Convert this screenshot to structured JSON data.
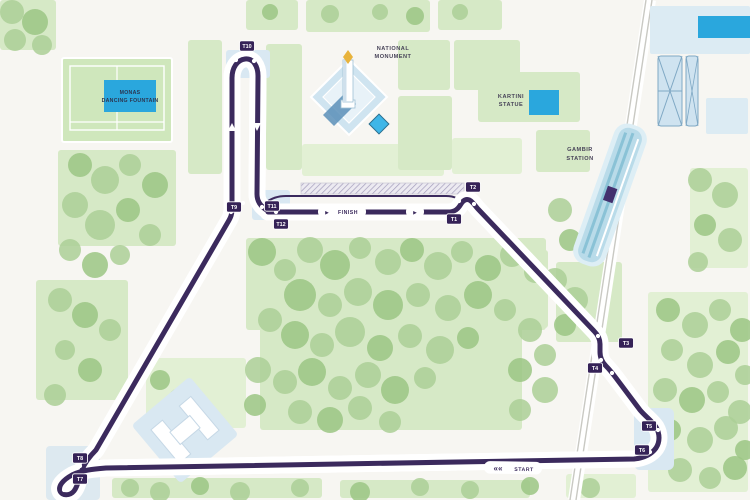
{
  "map": {
    "title": "Jakarta Monas street circuit map",
    "colors": {
      "background": "#f7f6f2",
      "park": "#d6e9c6",
      "park_light": "#e2f0d4",
      "tree": "#accf97",
      "tree_dark": "#9bc584",
      "track": "#3b2a5d",
      "turn_box": "#352257",
      "water_blue": "#2aa7dd",
      "pale_blue": "#d9e8f2",
      "station_blue": "#b9dbe9",
      "station_stripe": "#8ac2d6",
      "rail_gray": "#c9c9c3",
      "label_text": "#474358"
    },
    "labels": {
      "national_monument": [
        "NATIONAL",
        "MONUMENT"
      ],
      "monas_dancing_fountain": [
        "MONAS",
        "DANCING FOUNTAIN"
      ],
      "kartini_statue": [
        "KARTINI",
        "STATUE"
      ],
      "gambir_station": [
        "GAMBIR",
        "STATION"
      ]
    },
    "track": {
      "finish_label": "FINISH",
      "finish_arrow": "►",
      "start_label": "START",
      "start_chevrons": "««",
      "turns": [
        {
          "id": "T1",
          "x": 454,
          "y": 219
        },
        {
          "id": "T2",
          "x": 473,
          "y": 187
        },
        {
          "id": "T3",
          "x": 626,
          "y": 343
        },
        {
          "id": "T4",
          "x": 595,
          "y": 368
        },
        {
          "id": "T5",
          "x": 649,
          "y": 426
        },
        {
          "id": "T6",
          "x": 642,
          "y": 450
        },
        {
          "id": "T7",
          "x": 80,
          "y": 479
        },
        {
          "id": "T8",
          "x": 80,
          "y": 458
        },
        {
          "id": "T9",
          "x": 234,
          "y": 207
        },
        {
          "id": "T10",
          "x": 247,
          "y": 46
        },
        {
          "id": "T11",
          "x": 272,
          "y": 206
        },
        {
          "id": "T12",
          "x": 281,
          "y": 224
        }
      ]
    }
  }
}
